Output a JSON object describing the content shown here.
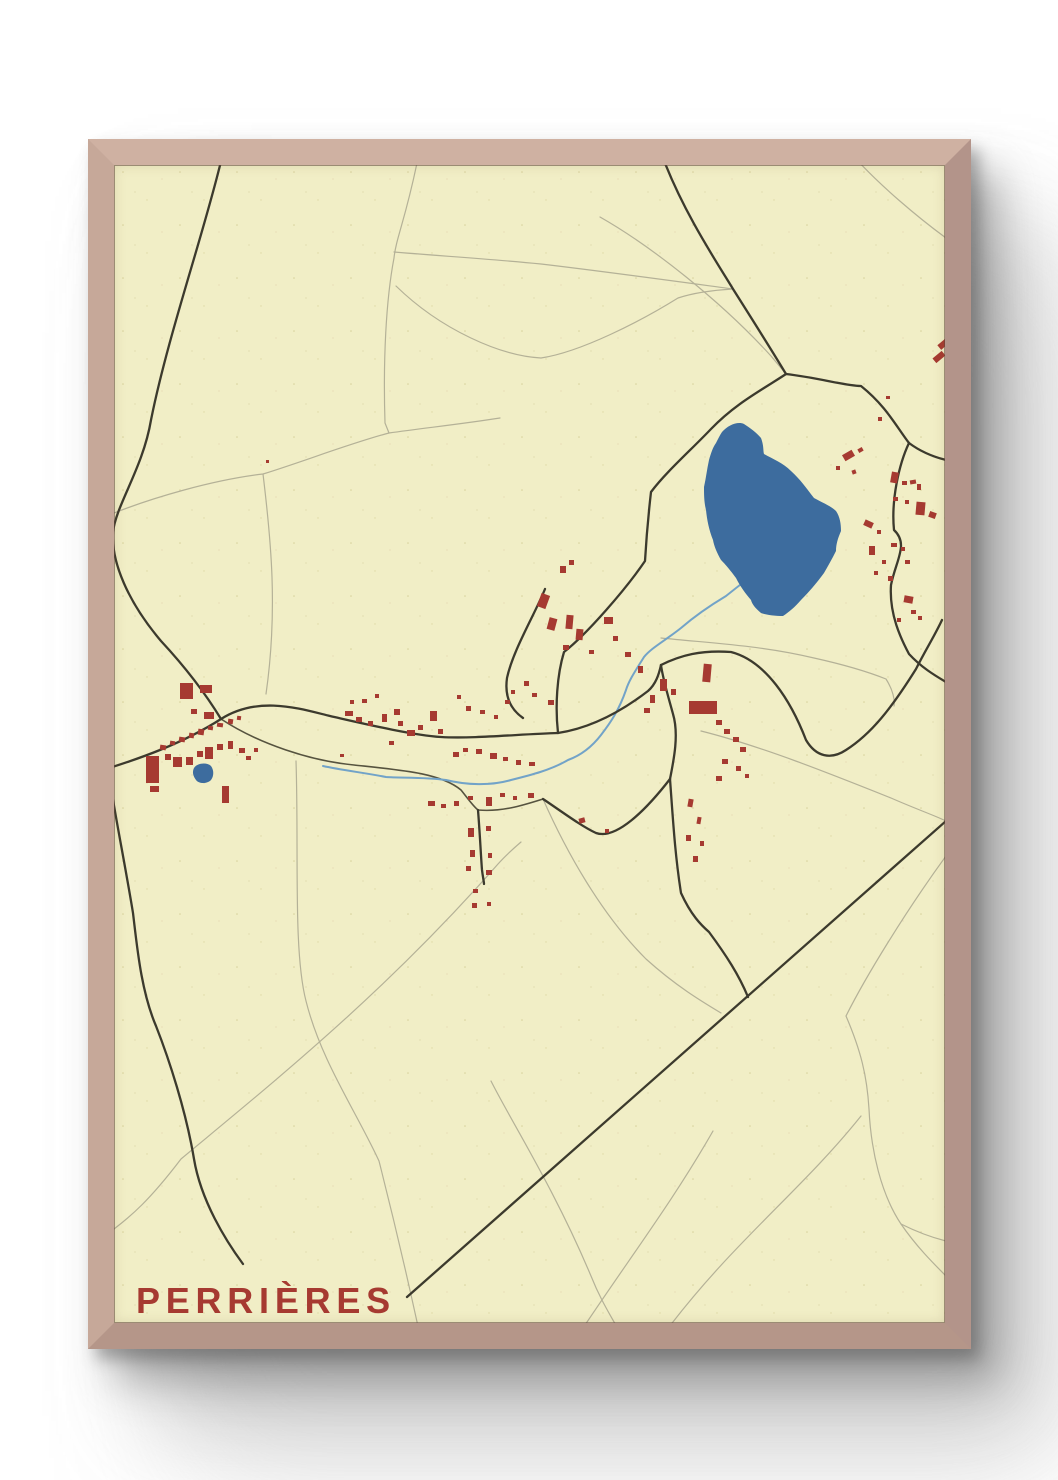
{
  "poster": {
    "title": "PERRIÈRES",
    "colors": {
      "paper": "#f1eec6",
      "frame_wood": "#c6a899",
      "title_text": "#a63a31",
      "building": "#a63a31",
      "road_major": "#3c3a2d",
      "road_medium": "#56533f",
      "road_minor": "#b4b197",
      "lake_water": "#3d6c9e",
      "stream_water": "#72a3c8",
      "page_background": "#ffffff"
    }
  },
  "map_data": {
    "type": "town-street-map",
    "town": "Perrières",
    "water": {
      "lake": "M722,432 C728,425 738,421 744,424 C750,428 756,432 761,438 C764,446 763,451 764,454 C773,459 783,463 791,471 C800,479 807,489 814,498 C823,503 831,506 836,511 C840,517 841,524 841,531 C838,538 836,544 836,551 C832,559 828,566 824,573 C816,584 808,593 801,600 C795,607 789,612 783,616 C775,616 767,615 761,613 C755,608 752,604 751,600 C745,593 740,586 736,578 C728,567 723,562 721,560 C717,553 714,546 713,540 C709,530 707,520 706,510 C704,502 704,494 704,487 C706,478 707,469 709,460 C711,453 713,447 716,443 C718,439 720,435 722,432 Z",
      "pond": "M194,768 C197,763 207,762 211,766 C214,770 214,776 211,780 C207,784 199,784 196,780 C193,776 192,772 194,768 Z",
      "streams": [
        "M761,569 C746,580 736,588 726,596 C711,605 696,615 681,628 C666,640 651,648 644,657 C636,670 629,680 626,690 C619,710 611,722 601,735 C591,748 579,756 568,760 C551,770 531,775 511,780 C491,786 466,785 446,780 C426,777 401,778 386,777 C366,773 341,770 323,766"
      ]
    },
    "roads": {
      "major": [
        "M222,157 C205,230 168,335 151,420 C143,468 116,505 113,532 C111,562 128,602 161,641 C187,669 207,696 221,719",
        "M106,769 C138,759 182,744 221,719 C259,695 301,709 330,716 C361,723 411,735 441,737 C472,739 521,734 558,733",
        "M558,733 C591,728 622,711 648,691 C656,684 659,674 661,665",
        "M786,374 C762,390 736,403 711,429 C691,450 666,472 651,492 C648,518 646,544 645,561 C626,589 587,634 564,652 C557,675 555,706 558,733",
        "M663,158 C684,213 716,261 733,289 C752,319 771,349 786,374",
        "M786,374 C820,378 846,386 861,386 C886,406 896,426 909,443 C921,452 934,457 946,460",
        "M909,443 C899,464 891,500 894,530 C909,544 896,560 891,585 C889,614 901,639 909,654 C921,667 934,675 946,682",
        "M661,665 C681,655 701,650 731,652 C766,661 791,701 806,740 C816,757 831,760 846,750 C871,734 891,709 916,669 C926,649 934,637 942,620",
        "M670,779 C674,759 679,734 673,714 C669,699 663,680 661,665",
        "M543,799 C561,811 581,826 596,833 C616,840 646,810 670,779",
        "M670,779 C673,820 675,855 681,893 C691,915 701,925 709,932 C726,955 739,975 748,997",
        "M946,821 L407,1297",
        "M109,776 C116,820 126,870 133,913 C137,946 141,991 156,1026 C169,1059 186,1111 194,1159 C201,1201 226,1241 243,1264",
        "M478,810 C480,835 481,858 482,870 C483,878 484,882 484,884",
        "M545,589 C535,614 513,650 507,678 C504,699 513,711 523,718"
      ],
      "medium": [
        "M221,719 C259,744 311,761 354,765 C401,770 441,773 461,790 C469,800 473,806 478,810 C501,812 521,806 543,799"
      ],
      "minor": [
        "M418,158 C406,218 396,238 394,258 C386,300 383,360 385,423 L389,433",
        "M114,513 C152,498 212,480 263,474 C302,462 351,443 389,433 C424,428 462,424 500,418",
        "M394,252 C441,256 491,259 541,264 C601,271 681,282 733,289",
        "M396,286 C441,330 501,356 541,358 C581,352 641,321 678,298 C696,292 716,290 733,289",
        "M857,160 C881,186 916,216 946,238",
        "M600,217 C651,246 721,301 771,356 L786,374",
        "M661,638 C721,644 764,646 814,658 C841,664 866,671 886,679 C893,690 895,700 894,706",
        "M701,731 C761,746 831,774 891,798 C916,809 936,816 946,821",
        "M543,799 C566,851 601,914 646,959 C676,986 701,1001 721,1013",
        "M296,761 C299,851 293,951 306,1001 C321,1061 356,1111 379,1161 C393,1216 406,1271 419,1331",
        "M114,1229 C131,1216 149,1201 181,1159 C271,1084 384,994 498,864 C506,855 514,848 521,842",
        "M491,1081 C511,1121 554,1188 591,1276 C601,1301 611,1316 619,1331",
        "M861,1116 C801,1191 734,1241 666,1331",
        "M946,856 C906,911 866,976 846,1016 C861,1051 867,1076 869,1109 C871,1151 881,1194 901,1224 C916,1246 933,1263 946,1276",
        "M901,1224 C919,1233 934,1238 946,1241",
        "M263,474 C271,540 278,610 266,694",
        "M713,1131 C673,1201 631,1256 581,1331"
      ]
    },
    "buildings": [
      [
        180,
        683,
        13,
        16,
        0
      ],
      [
        200,
        685,
        12,
        8,
        0
      ],
      [
        191,
        709,
        6,
        5,
        0
      ],
      [
        204,
        712,
        10,
        7,
        0
      ],
      [
        160,
        745,
        6,
        5,
        8
      ],
      [
        170,
        741,
        5,
        4,
        8
      ],
      [
        179,
        737,
        6,
        5,
        8
      ],
      [
        189,
        733,
        5,
        5,
        8
      ],
      [
        198,
        729,
        6,
        6,
        8
      ],
      [
        208,
        726,
        5,
        4,
        8
      ],
      [
        217,
        723,
        6,
        4,
        8
      ],
      [
        228,
        719,
        5,
        5,
        8
      ],
      [
        237,
        716,
        4,
        4,
        8
      ],
      [
        146,
        756,
        13,
        27,
        0
      ],
      [
        150,
        786,
        9,
        6,
        0
      ],
      [
        165,
        754,
        6,
        6,
        0
      ],
      [
        173,
        757,
        9,
        10,
        0
      ],
      [
        186,
        757,
        7,
        8,
        0
      ],
      [
        197,
        751,
        6,
        6,
        0
      ],
      [
        205,
        747,
        8,
        12,
        0
      ],
      [
        217,
        744,
        6,
        6,
        0
      ],
      [
        228,
        741,
        5,
        8,
        0
      ],
      [
        239,
        748,
        6,
        5,
        0
      ],
      [
        222,
        786,
        7,
        17,
        0
      ],
      [
        246,
        756,
        5,
        4,
        0
      ],
      [
        254,
        748,
        4,
        4,
        0
      ],
      [
        340,
        754,
        4,
        3,
        0
      ],
      [
        266,
        460,
        3,
        3,
        0
      ],
      [
        345,
        711,
        8,
        5,
        0
      ],
      [
        356,
        717,
        6,
        5,
        0
      ],
      [
        368,
        721,
        5,
        5,
        0
      ],
      [
        382,
        714,
        5,
        8,
        0
      ],
      [
        394,
        709,
        6,
        6,
        0
      ],
      [
        398,
        721,
        5,
        5,
        0
      ],
      [
        407,
        730,
        8,
        6,
        0
      ],
      [
        418,
        725,
        5,
        5,
        0
      ],
      [
        430,
        711,
        7,
        10,
        0
      ],
      [
        438,
        729,
        5,
        5,
        0
      ],
      [
        362,
        699,
        5,
        4,
        0
      ],
      [
        375,
        694,
        4,
        4,
        0
      ],
      [
        389,
        741,
        5,
        4,
        0
      ],
      [
        350,
        700,
        4,
        4,
        0
      ],
      [
        539,
        594,
        9,
        14,
        20
      ],
      [
        548,
        618,
        8,
        12,
        15
      ],
      [
        560,
        566,
        6,
        7,
        0
      ],
      [
        569,
        560,
        5,
        5,
        0
      ],
      [
        566,
        615,
        7,
        14,
        5
      ],
      [
        576,
        629,
        7,
        11,
        5
      ],
      [
        563,
        645,
        6,
        5,
        0
      ],
      [
        589,
        650,
        5,
        4,
        0
      ],
      [
        604,
        617,
        9,
        7,
        0
      ],
      [
        613,
        636,
        5,
        5,
        0
      ],
      [
        625,
        652,
        6,
        5,
        0
      ],
      [
        638,
        666,
        5,
        7,
        0
      ],
      [
        689,
        701,
        28,
        13,
        0
      ],
      [
        703,
        664,
        8,
        18,
        5
      ],
      [
        660,
        679,
        7,
        12,
        0
      ],
      [
        671,
        689,
        5,
        6,
        0
      ],
      [
        650,
        695,
        5,
        8,
        0
      ],
      [
        644,
        708,
        6,
        5,
        0
      ],
      [
        716,
        720,
        6,
        5,
        0
      ],
      [
        724,
        729,
        6,
        5,
        0
      ],
      [
        733,
        737,
        6,
        5,
        0
      ],
      [
        740,
        747,
        6,
        5,
        0
      ],
      [
        722,
        759,
        6,
        5,
        0
      ],
      [
        736,
        766,
        5,
        5,
        0
      ],
      [
        716,
        776,
        6,
        5,
        0
      ],
      [
        745,
        774,
        4,
        4,
        0
      ],
      [
        453,
        752,
        6,
        5,
        0
      ],
      [
        463,
        748,
        5,
        4,
        0
      ],
      [
        476,
        749,
        6,
        5,
        0
      ],
      [
        490,
        753,
        7,
        6,
        0
      ],
      [
        503,
        757,
        5,
        4,
        0
      ],
      [
        516,
        760,
        5,
        5,
        0
      ],
      [
        529,
        762,
        6,
        4,
        0
      ],
      [
        548,
        700,
        6,
        5,
        0
      ],
      [
        532,
        693,
        5,
        4,
        0
      ],
      [
        524,
        681,
        5,
        5,
        0
      ],
      [
        511,
        690,
        4,
        4,
        0
      ],
      [
        505,
        700,
        5,
        4,
        0
      ],
      [
        466,
        706,
        5,
        5,
        0
      ],
      [
        480,
        710,
        5,
        4,
        0
      ],
      [
        494,
        715,
        4,
        4,
        0
      ],
      [
        457,
        695,
        4,
        4,
        0
      ],
      [
        428,
        801,
        7,
        5,
        0
      ],
      [
        441,
        804,
        5,
        4,
        0
      ],
      [
        454,
        801,
        5,
        5,
        0
      ],
      [
        468,
        796,
        5,
        4,
        0
      ],
      [
        486,
        797,
        6,
        9,
        0
      ],
      [
        500,
        793,
        5,
        4,
        0
      ],
      [
        513,
        796,
        4,
        4,
        0
      ],
      [
        528,
        793,
        6,
        5,
        0
      ],
      [
        468,
        828,
        6,
        9,
        0
      ],
      [
        486,
        826,
        5,
        5,
        0
      ],
      [
        470,
        850,
        5,
        7,
        0
      ],
      [
        488,
        853,
        4,
        5,
        0
      ],
      [
        466,
        866,
        5,
        5,
        0
      ],
      [
        486,
        870,
        6,
        5,
        0
      ],
      [
        473,
        889,
        5,
        4,
        0
      ],
      [
        487,
        902,
        4,
        4,
        0
      ],
      [
        472,
        903,
        5,
        5,
        0
      ],
      [
        579,
        818,
        6,
        5,
        -15
      ],
      [
        605,
        829,
        4,
        4,
        0
      ],
      [
        688,
        799,
        5,
        8,
        10
      ],
      [
        697,
        817,
        4,
        7,
        10
      ],
      [
        686,
        835,
        5,
        6,
        0
      ],
      [
        700,
        841,
        4,
        5,
        0
      ],
      [
        693,
        856,
        5,
        6,
        0
      ],
      [
        843,
        452,
        11,
        7,
        -30
      ],
      [
        836,
        466,
        4,
        4,
        0
      ],
      [
        852,
        470,
        4,
        4,
        -20
      ],
      [
        858,
        448,
        5,
        4,
        -30
      ],
      [
        878,
        417,
        4,
        4,
        0
      ],
      [
        886,
        396,
        4,
        3,
        0
      ],
      [
        891,
        472,
        7,
        11,
        10
      ],
      [
        902,
        481,
        5,
        4,
        0
      ],
      [
        910,
        480,
        6,
        4,
        -10
      ],
      [
        917,
        484,
        4,
        6,
        0
      ],
      [
        893,
        497,
        5,
        4,
        0
      ],
      [
        905,
        500,
        4,
        4,
        0
      ],
      [
        916,
        502,
        9,
        13,
        5
      ],
      [
        929,
        512,
        7,
        6,
        20
      ],
      [
        864,
        521,
        9,
        6,
        25
      ],
      [
        877,
        530,
        4,
        4,
        0
      ],
      [
        869,
        546,
        6,
        9,
        0
      ],
      [
        882,
        560,
        4,
        4,
        0
      ],
      [
        891,
        543,
        6,
        4,
        0
      ],
      [
        901,
        547,
        4,
        4,
        0
      ],
      [
        874,
        571,
        4,
        4,
        0
      ],
      [
        888,
        576,
        5,
        5,
        0
      ],
      [
        905,
        560,
        5,
        4,
        0
      ],
      [
        904,
        596,
        9,
        7,
        10
      ],
      [
        911,
        610,
        5,
        4,
        0
      ],
      [
        897,
        618,
        4,
        4,
        0
      ],
      [
        918,
        616,
        4,
        4,
        0
      ],
      [
        938,
        341,
        11,
        6,
        -40
      ],
      [
        933,
        354,
        12,
        6,
        -40
      ]
    ]
  }
}
